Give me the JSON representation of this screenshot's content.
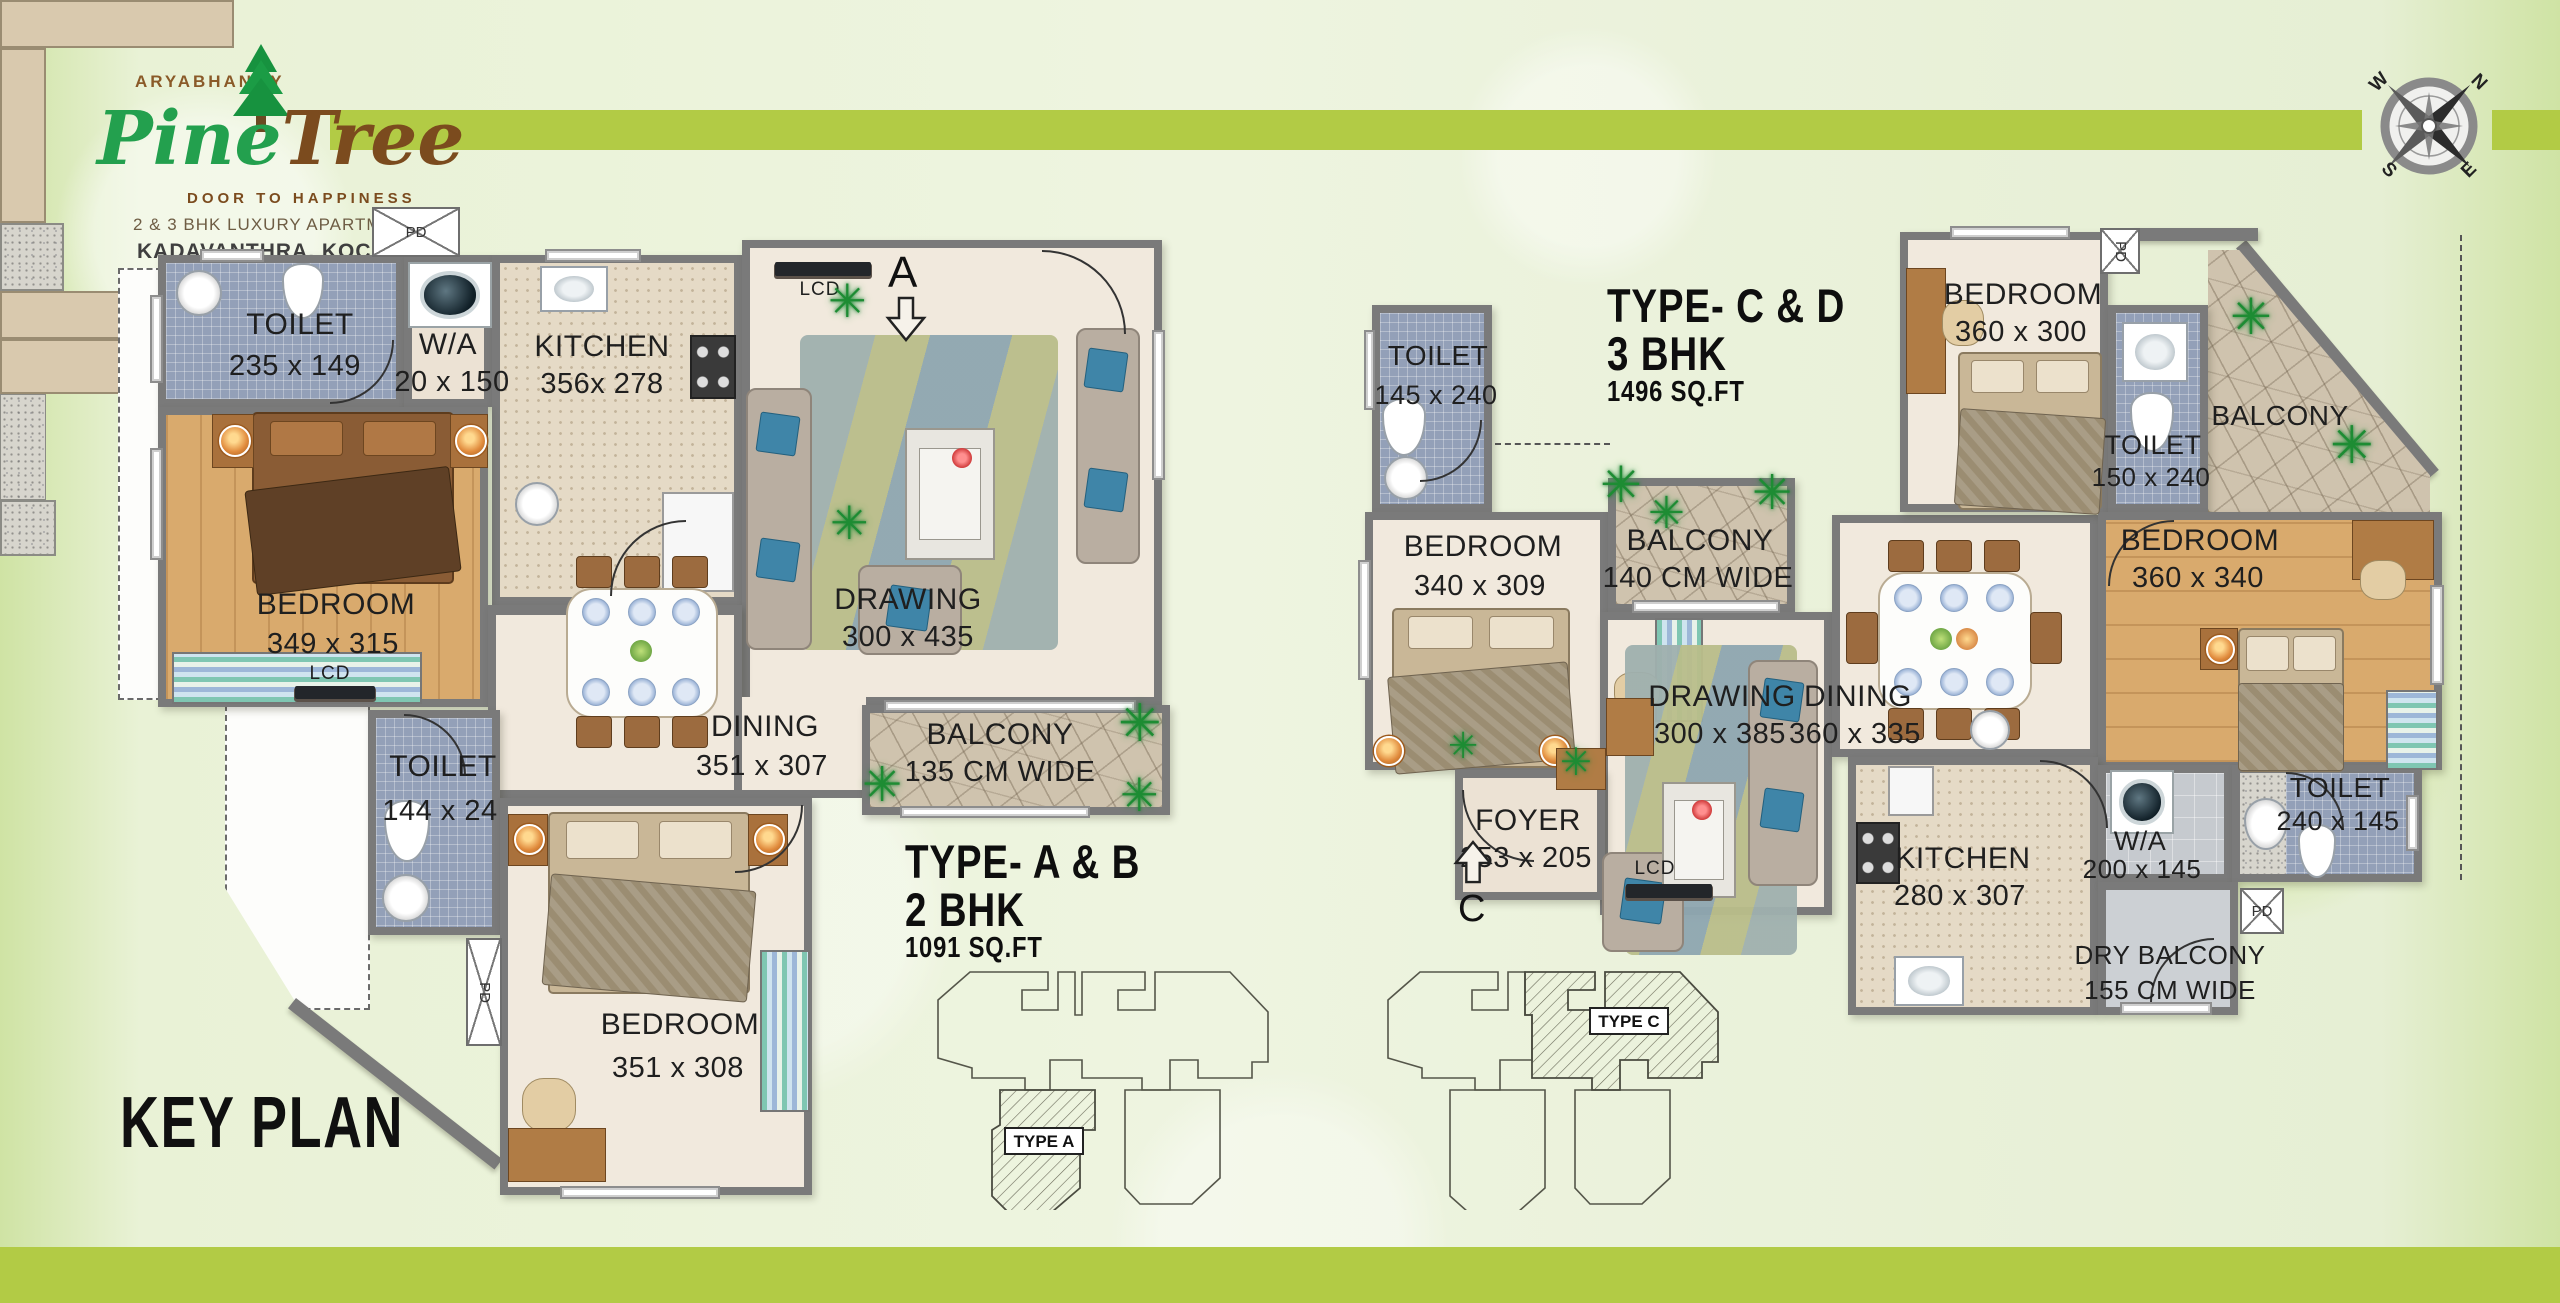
{
  "page": {
    "accent_green": "#b2cb45",
    "wall_gray": "#7a7a7a"
  },
  "logo": {
    "brand_top": "ARYABHANGY",
    "brand_green": "Pine",
    "brand_brown": "Tree",
    "tagline": "DOOR TO HAPPINESS",
    "subtitle": "2 & 3 BHK LUXURY APARTMENT",
    "location": "KADAVANTHRA, KOCHI"
  },
  "compass": {
    "n": "N",
    "e": "E",
    "s": "S",
    "w": "W"
  },
  "key_plan": {
    "title": "KEY PLAN",
    "type_a_label": "TYPE A",
    "type_c_label": "TYPE C"
  },
  "plan_a": {
    "heading": {
      "type": "TYPE- A & B",
      "bhk": "2 BHK",
      "area": "1091 SQ.FT"
    },
    "entrance_label": "A",
    "shaft_label": "PD",
    "lcd_label": "LCD",
    "rooms": {
      "toilet1": {
        "name": "TOILET",
        "dims": "235 x 149"
      },
      "wa": {
        "name": "W/A",
        "dims": "20 x 150"
      },
      "kitchen": {
        "name": "KITCHEN",
        "dims": "356x 278"
      },
      "bedroom1": {
        "name": "BEDROOM",
        "dims": "349 x 315"
      },
      "drawing": {
        "name": "DRAWING",
        "dims": "300 x 435"
      },
      "dining": {
        "name": "DINING",
        "dims": "351 x 307"
      },
      "balcony": {
        "name": "BALCONY",
        "dims": "135 CM  WIDE"
      },
      "toilet2": {
        "name": "TOILET",
        "dims": "144 x 24"
      },
      "bedroom2": {
        "name": "BEDROOM",
        "dims": "351 x 308"
      }
    }
  },
  "plan_cd": {
    "heading": {
      "type": "TYPE- C & D",
      "bhk": "3 BHK",
      "area": "1496 SQ.FT"
    },
    "entrance_label": "C",
    "shaft_label": "PD",
    "lcd_label": "LCD",
    "rooms": {
      "toilet1": {
        "name": "TOILET",
        "dims": "145 x 240"
      },
      "bedroom1": {
        "name": "BEDROOM",
        "dims": "340 x 309"
      },
      "balcony1": {
        "name": "BALCONY",
        "dims": "140 CM WIDE"
      },
      "bedroom2": {
        "name": "BEDROOM",
        "dims": "360 x 300"
      },
      "toilet2": {
        "name": "TOILET",
        "dims": "150 x 240"
      },
      "balcony2": {
        "name": "BALCONY"
      },
      "bedroom3": {
        "name": "BEDROOM",
        "dims": "360 x 340"
      },
      "drawing": {
        "name": "DRAWING",
        "dims": "300 x 385"
      },
      "dining": {
        "name": "DINING",
        "dims": "360 x 335"
      },
      "foyer": {
        "name": "FOYER",
        "dims": "253 x 205"
      },
      "kitchen": {
        "name": "KITCHEN",
        "dims": "280 x 307"
      },
      "wa": {
        "name": "W/A",
        "dims": "200 x 145"
      },
      "toilet3": {
        "name": "TOILET",
        "dims": "240 x 145"
      },
      "dry_balcony": {
        "name": "DRY BALCONY",
        "dims": "155 CM  WIDE"
      }
    }
  }
}
